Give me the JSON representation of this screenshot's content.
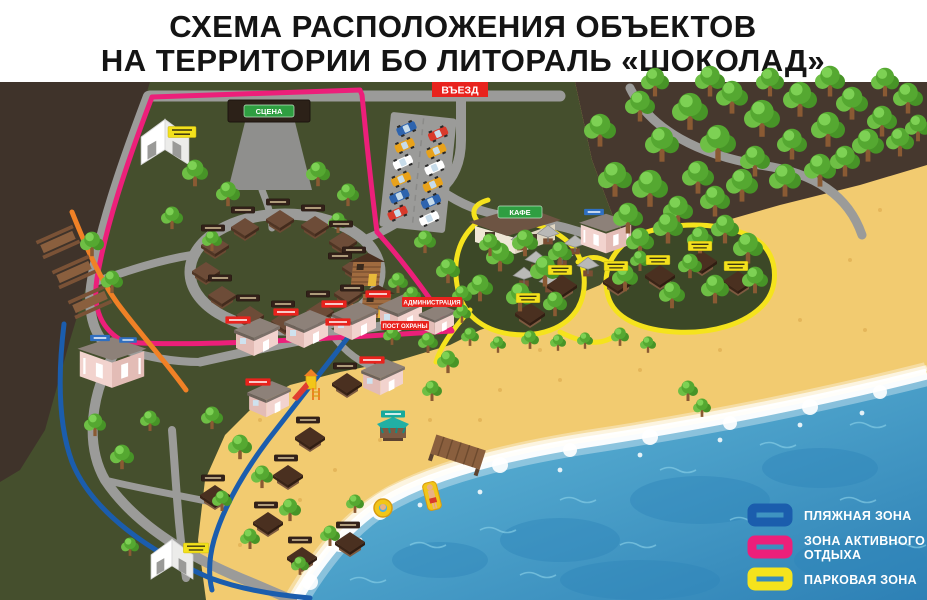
{
  "header": {
    "title_line1": "СХЕМА РАСПОЛОЖЕНИЯ ОБЪЕКТОВ",
    "title_line2": "НА ТЕРРИТОРИИ БО ЛИТОРАЛЬ «ШОКОЛАД»"
  },
  "map": {
    "entrance_badge": "ВЪЕЗД",
    "stage_sign": "СЦЕНА",
    "cafe_sign": "КАФЕ",
    "administration_badge": "АДМИНИСТРАЦИЯ",
    "security_post_badge": "ПОСТ ОХРАНЫ"
  },
  "legend": {
    "items": [
      {
        "lines": [
          "ПЛЯЖНАЯ ЗОНА"
        ],
        "color": "#1b5dad"
      },
      {
        "lines": [
          "ЗОНА АКТИВНОГО",
          "ОТДЫХА"
        ],
        "color": "#ec1f7a"
      },
      {
        "lines": [
          "ПАРКОВАЯ ЗОНА"
        ],
        "color": "#f5e31d"
      }
    ]
  },
  "colors": {
    "beach_zone_line": "#1b5dad",
    "active_zone_line": "#ec1f7a",
    "park_zone_line": "#f5e31d",
    "path_orange_line": "#f08126",
    "entrance_red": "#e8231d",
    "sign_green": "#2f9e41",
    "sea": "#3f97c4",
    "sand": "#f2cb70",
    "camp_green": "#454f2d",
    "ground_brown": "#46382e"
  }
}
